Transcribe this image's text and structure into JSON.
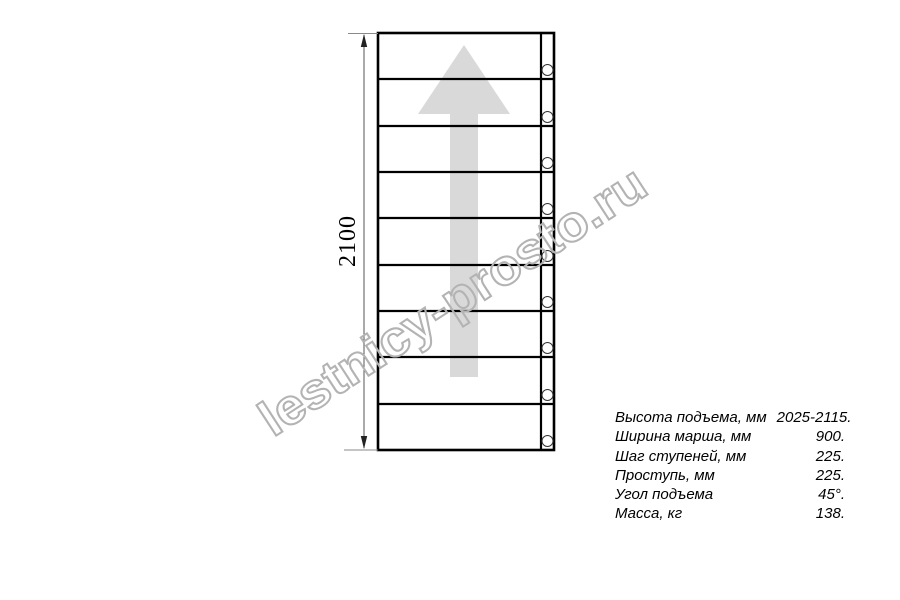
{
  "diagram": {
    "type": "staircase-plan-top-view",
    "dimension_label": "2100",
    "steps_count": 9,
    "arrow_color": "#d9d9d9",
    "line_color": "#000000"
  },
  "watermark": {
    "text": "lestnicy-prosto.ru",
    "color": "#b3b3b3"
  },
  "specs": {
    "rows": [
      {
        "label": "Высота подъема, мм",
        "value": "2025-2115."
      },
      {
        "label": "Ширина марша, мм",
        "value": "900."
      },
      {
        "label": "Шаг ступеней, мм",
        "value": "225."
      },
      {
        "label": "Проступь, мм",
        "value": "225."
      },
      {
        "label": "Угол подъема",
        "value": "45°."
      },
      {
        "label": "Масса, кг",
        "value": "138."
      }
    ]
  }
}
